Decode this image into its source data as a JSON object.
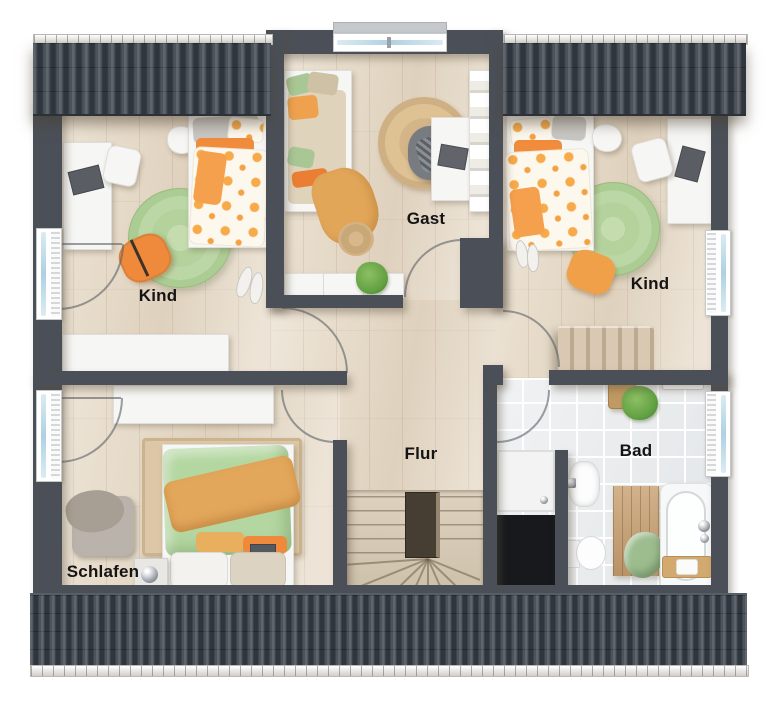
{
  "floorplan": {
    "type": "upper-floor-plan",
    "rooms": [
      {
        "id": "kind-left",
        "label": "Kind"
      },
      {
        "id": "gast",
        "label": "Gast"
      },
      {
        "id": "kind-right",
        "label": "Kind"
      },
      {
        "id": "flur",
        "label": "Flur"
      },
      {
        "id": "bad",
        "label": "Bad"
      },
      {
        "id": "schlafen",
        "label": "Schlafen"
      }
    ],
    "colors": {
      "wall": "#4b5058",
      "roof": "#434a54",
      "floor_wood": "#e8ddcc",
      "floor_tile": "#e9ebec",
      "shaft_black": "#17191c",
      "accent_orange": "#ef8b3e",
      "accent_mustard": "#e2a659",
      "accent_green_rug": "#b4d29c",
      "accent_green_duvet": "#b4d7a1",
      "jute": "#d8bb8e",
      "furniture_white": "#f6f6f4"
    }
  }
}
